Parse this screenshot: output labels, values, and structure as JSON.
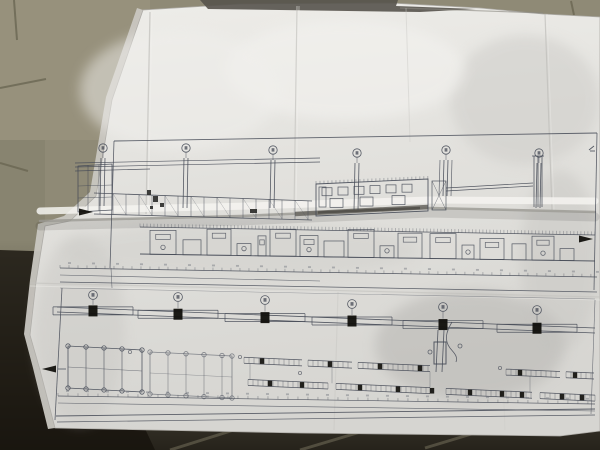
{
  "scene": {
    "colors": {
      "floor_tile": "#8f8a76",
      "floor_tile_light": "#9a947f",
      "floor_grout": "#6b6753",
      "floor_dark": "#16130c",
      "paper_light": "#eeede9",
      "paper_mid": "#e2e1dd",
      "paper_dark": "#d6d5d1",
      "crease_shadow": "#c3c2be",
      "ridge_shadow": "#6e6c66",
      "top_band": "#56534c",
      "ink": "#454a56",
      "black_fill": "#12110d"
    },
    "floor": {
      "grout_lines": [
        [
          14,
          0,
          17,
          40
        ],
        [
          0,
          88,
          46,
          79
        ],
        [
          0,
          163,
          28,
          171
        ],
        [
          24,
          330,
          42,
          334
        ],
        [
          571,
          1,
          574,
          15
        ]
      ],
      "streaks": [
        [
          170,
          450,
          237,
          429
        ],
        [
          300,
          450,
          367,
          430
        ],
        [
          425,
          448,
          478,
          432
        ]
      ],
      "dark_left_poly": [
        [
          0,
          250
        ],
        [
          62,
          252
        ],
        [
          155,
          450
        ],
        [
          0,
          450
        ]
      ]
    },
    "paper": {
      "outline": [
        [
          143,
          10
        ],
        [
          240,
          4
        ],
        [
          390,
          3
        ],
        [
          480,
          8
        ],
        [
          543,
          14
        ],
        [
          600,
          17
        ],
        [
          600,
          431
        ],
        [
          560,
          436
        ],
        [
          300,
          433
        ],
        [
          55,
          428
        ],
        [
          40,
          370
        ],
        [
          30,
          335
        ],
        [
          36,
          282
        ],
        [
          45,
          226
        ],
        [
          70,
          221
        ],
        [
          96,
          196
        ],
        [
          112,
          100
        ]
      ],
      "under_sheet": [
        [
          137,
          8
        ],
        [
          106,
          97
        ],
        [
          90,
          192
        ],
        [
          64,
          216
        ],
        [
          38,
          224
        ],
        [
          30,
          280
        ],
        [
          24,
          334
        ],
        [
          33,
          368
        ],
        [
          48,
          429
        ],
        [
          55,
          428
        ],
        [
          40,
          370
        ],
        [
          30,
          335
        ],
        [
          36,
          282
        ],
        [
          45,
          226
        ],
        [
          70,
          221
        ],
        [
          96,
          196
        ],
        [
          112,
          100
        ],
        [
          143,
          10
        ]
      ],
      "top_band": [
        [
          200,
          0
        ],
        [
          398,
          0
        ],
        [
          396,
          6
        ],
        [
          476,
          9
        ],
        [
          420,
          12
        ],
        [
          208,
          9
        ]
      ],
      "creases": [
        [
          150,
          12,
          146,
          214,
          1.3,
          0.75,
          "#c3c2be"
        ],
        [
          152,
          12,
          148,
          214,
          1.0,
          0.6,
          "#f1f0ed"
        ],
        [
          297,
          6,
          294,
          212,
          1.2,
          0.7,
          "#c6c5c1"
        ],
        [
          299,
          6,
          296,
          212,
          1.0,
          0.5,
          "#f1f0ed"
        ],
        [
          406,
          8,
          410,
          142,
          1.0,
          0.45,
          "#c9c8c4"
        ],
        [
          545,
          14,
          552,
          210,
          1.2,
          0.7,
          "#bfbeba"
        ],
        [
          547,
          14,
          554,
          210,
          0.8,
          0.5,
          "#ecebe8"
        ],
        [
          338,
          292,
          334,
          430,
          1.2,
          0.35,
          "#c2c1bd"
        ],
        [
          30,
          283,
          600,
          297,
          1.3,
          0.6,
          "#c3c2be"
        ],
        [
          30,
          286,
          600,
          300,
          1.0,
          0.45,
          "#efeeea"
        ],
        [
          500,
          302,
          505,
          430,
          1.0,
          0.25,
          "#c6c5c1"
        ]
      ],
      "shade_blobs": [
        [
          470,
          345,
          95,
          55,
          "#b7b6b2",
          0.55
        ],
        [
          525,
          100,
          75,
          65,
          "#cccbc7",
          0.5
        ],
        [
          345,
          70,
          120,
          50,
          "#f3f2ef",
          0.6
        ],
        [
          180,
          90,
          100,
          60,
          "#f0efec",
          0.5
        ],
        [
          80,
          330,
          45,
          95,
          "#c6c5c1",
          0.4
        ],
        [
          240,
          250,
          180,
          28,
          "#cbcac6",
          0.35
        ],
        [
          560,
          260,
          40,
          90,
          "#c2c1bd",
          0.4
        ]
      ],
      "ridge": {
        "highlight": [
          [
            40,
            211
          ],
          [
            250,
            206
          ],
          [
            430,
            200
          ],
          [
            595,
            201
          ]
        ],
        "shadow": [
          [
            40,
            221
          ],
          [
            240,
            216
          ],
          [
            430,
            208
          ],
          [
            595,
            212
          ]
        ],
        "blade": [
          295,
          214,
          428,
          207
        ]
      }
    }
  },
  "drawing": {
    "ink": "#454a56",
    "upper": {
      "frame_lines": [
        [
          114,
          141,
          597,
          133,
          0.9
        ],
        [
          597,
          133,
          594,
          290,
          0.8
        ],
        [
          114,
          141,
          110,
          268,
          0.8
        ]
      ],
      "grid_bubbles": [
        [
          103,
          148
        ],
        [
          186,
          148
        ],
        [
          273,
          150
        ],
        [
          357,
          153
        ],
        [
          446,
          150
        ],
        [
          539,
          153
        ]
      ],
      "col_end_y": [
        206,
        208,
        208,
        210,
        196,
        208
      ],
      "extra_pair": {
        "x": 446,
        "off": 6,
        "y2": 196
      },
      "chimney_x": [
        534,
        538,
        542
      ],
      "chimney_y": [
        156,
        207
      ],
      "rack_lines": [
        [
          75,
          163,
          320,
          158
        ],
        [
          75,
          167,
          320,
          162
        ],
        [
          75,
          171,
          150,
          169
        ]
      ],
      "left_frame": {
        "pts": [
          [
            78,
            166
          ],
          [
            112,
            164
          ],
          [
            112,
            210
          ],
          [
            78,
            212
          ]
        ],
        "vx": [
          88,
          99
        ],
        "hy": [
          186,
          198
        ]
      },
      "truss": {
        "x1": 94,
        "y1t": 193,
        "x2": 312,
        "y2t": 201,
        "y1b": 214,
        "y2b": 220,
        "step": 13
      },
      "junction_rects": [
        [
          147,
          190,
          4,
          5
        ],
        [
          153,
          196,
          5,
          6
        ],
        [
          160,
          203,
          4,
          4
        ],
        [
          150,
          206,
          3,
          3
        ],
        [
          250,
          209,
          7,
          4
        ]
      ],
      "windows_block": {
        "top": [
          [
            316,
            184
          ],
          [
            428,
            179
          ]
        ],
        "bot": [
          [
            316,
            216
          ],
          [
            428,
            211
          ]
        ],
        "row1_xs": [
          322,
          338,
          354,
          370,
          386,
          402
        ],
        "row1_wh": [
          10,
          8
        ],
        "row1_dy": 4,
        "row2_xs": [
          330,
          360,
          392
        ],
        "row2_wh": [
          13,
          9
        ],
        "row2_dy": 15,
        "left_rect": [
          319,
          187,
          7,
          20
        ]
      },
      "tower_rect": [
        432,
        181,
        14,
        29
      ],
      "pipes": [
        [
          446,
          188,
          533,
          183
        ],
        [
          446,
          191,
          533,
          186
        ]
      ],
      "roof_hatch": {
        "x1": 140,
        "y1": 227,
        "x2": 595,
        "y2": 235,
        "step": 3.5,
        "len": 3.5
      },
      "ground": [
        140,
        254,
        595,
        261
      ],
      "modules": [
        [
          150,
          26,
          24
        ],
        [
          183,
          18,
          15
        ],
        [
          207,
          24,
          26
        ],
        [
          237,
          14,
          12
        ],
        [
          258,
          8,
          20
        ],
        [
          270,
          26,
          27
        ],
        [
          300,
          18,
          21
        ],
        [
          324,
          20,
          16
        ],
        [
          348,
          26,
          28
        ],
        [
          380,
          14,
          12
        ],
        [
          398,
          24,
          25
        ],
        [
          430,
          26,
          25
        ],
        [
          462,
          12,
          14
        ],
        [
          480,
          24,
          21
        ],
        [
          512,
          14,
          16
        ],
        [
          532,
          22,
          24
        ],
        [
          560,
          14,
          12
        ]
      ],
      "dim1": {
        "x1": 60,
        "y1": 268,
        "x2": 597,
        "y2": 277,
        "step": 9,
        "len": 3
      },
      "dim2": [
        60,
        275,
        320,
        281
      ],
      "bottom_line": [
        60,
        282,
        597,
        292
      ],
      "arrows": [
        [
          93,
          212,
          1
        ],
        [
          593,
          239,
          1
        ]
      ],
      "glyph": [
        589,
        150
      ]
    },
    "lower": {
      "top_line": [
        60,
        288,
        595,
        299
      ],
      "rail": {
        "x1": 57,
        "y1": 309.5,
        "x2": 595,
        "y2": 330.5,
        "gap": 5
      },
      "grid_bubbles": [
        [
          93,
          295
        ],
        [
          178,
          297
        ],
        [
          265,
          300
        ],
        [
          352,
          304
        ],
        [
          443,
          307
        ],
        [
          537,
          310
        ]
      ],
      "beam_half": 40,
      "col_size": [
        9,
        11
      ],
      "left_border": [
        62,
        288,
        55,
        420
      ],
      "right_border": [
        595,
        300,
        591,
        414
      ],
      "frames": [
        {
          "pts": [
            [
              68,
              346
            ],
            [
              142,
              350
            ],
            [
              142,
              392
            ],
            [
              68,
              388
            ]
          ],
          "vx": [
            86,
            104,
            122
          ],
          "op": 0.9
        },
        {
          "pts": [
            [
              150,
              352
            ],
            [
              232,
              356
            ],
            [
              232,
              398
            ],
            [
              150,
              394
            ]
          ],
          "vx": [
            168,
            186,
            204,
            222
          ],
          "op": 0.6
        }
      ],
      "slope": 0.045,
      "x0": 60,
      "row1": {
        "base": 352,
        "segs": [
          [
            244,
            58
          ],
          [
            308,
            44
          ],
          [
            358,
            72
          ],
          [
            506,
            54
          ],
          [
            566,
            28
          ]
        ]
      },
      "row2": {
        "base": 374,
        "segs": [
          [
            248,
            80
          ],
          [
            336,
            94
          ],
          [
            446,
            86
          ],
          [
            540,
            55
          ]
        ]
      },
      "dashes1": [
        262,
        330,
        380,
        420,
        520,
        575
      ],
      "dashes2": [
        270,
        302,
        360,
        398,
        432,
        470,
        502,
        522,
        562,
        582
      ],
      "connectors": [
        250,
        332,
        430,
        530
      ],
      "center_detail": {
        "vlines": [
          [
            438,
            330,
            436,
            372
          ],
          [
            444,
            330,
            442,
            372
          ]
        ],
        "rect": [
          434,
          342,
          12,
          22
        ],
        "curve": "M452,322 C446,332 444,340 450,348 C454,353 458,356 456,362",
        "circles": [
          [
            430,
            352
          ],
          [
            460,
            346
          ]
        ]
      },
      "dim1": {
        "x1": 58,
        "y1": 396,
        "x2": 595,
        "y2": 404,
        "step": 10,
        "len": 3
      },
      "dim2": [
        58,
        403,
        595,
        411
      ],
      "bottom_lines": [
        [
          56,
          416,
          595,
          409,
          0.9
        ],
        [
          57,
          422,
          595,
          415,
          0.7
        ]
      ],
      "arrow": [
        42,
        369,
        -1
      ],
      "small_circles": [
        [
          130,
          352
        ],
        [
          240,
          357
        ],
        [
          300,
          373
        ],
        [
          500,
          368
        ]
      ]
    }
  }
}
